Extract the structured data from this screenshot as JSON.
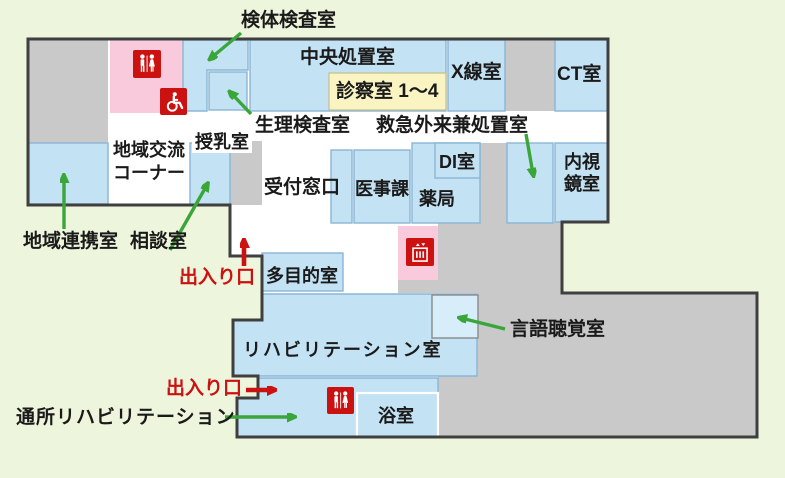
{
  "colors": {
    "bg": "#edf6dc",
    "building_fill": "#ffffff",
    "outline": "#3f3f3f",
    "corridor_gray": "#c9c9c9",
    "room_blue": "#c3e2f4",
    "room_blue_light": "#d7edf9",
    "pink": "#f8cadb",
    "yellow": "#faf4c3",
    "accent_red": "#cc1111",
    "accent_green": "#3aa63a"
  },
  "map": {
    "room_labels": {
      "central_treatment": "中央処置室",
      "consult_rooms": "診察室 1～4",
      "xray": "X線室",
      "ct": "CT室",
      "physiology_lab": "生理検査室",
      "emergency_treatment": "救急外来兼処置室",
      "community_corner_line1": "地域交流",
      "community_corner_line2": "コーナー",
      "nursing_room": "授乳室",
      "reception": "受付窓口",
      "medical_affairs": "医事課",
      "di_room": "DI室",
      "pharmacy": "薬局",
      "endoscopy_line1": "内視",
      "endoscopy_line2": "鏡室",
      "multipurpose": "多目的室",
      "rehabilitation": "リハビリテーション室",
      "bathroom": "浴室"
    },
    "callout_labels": {
      "specimen_lab": "検体検査室",
      "regional_cooperation": "地域連携室",
      "consultation_room": "相談室",
      "entrance_north": "出入り口",
      "entrance_west": "出入り口",
      "speech_therapy": "言語聴覚室",
      "outpatient_rehab": "通所リハビリテーション"
    },
    "icons": {
      "toilet_upper": "mens-womens-toilet-icon",
      "wheelchair_toilet": "wheelchair-accessible-toilet-icon",
      "elevator": "elevator-icon",
      "toilet_lower": "mens-womens-toilet-icon"
    }
  }
}
